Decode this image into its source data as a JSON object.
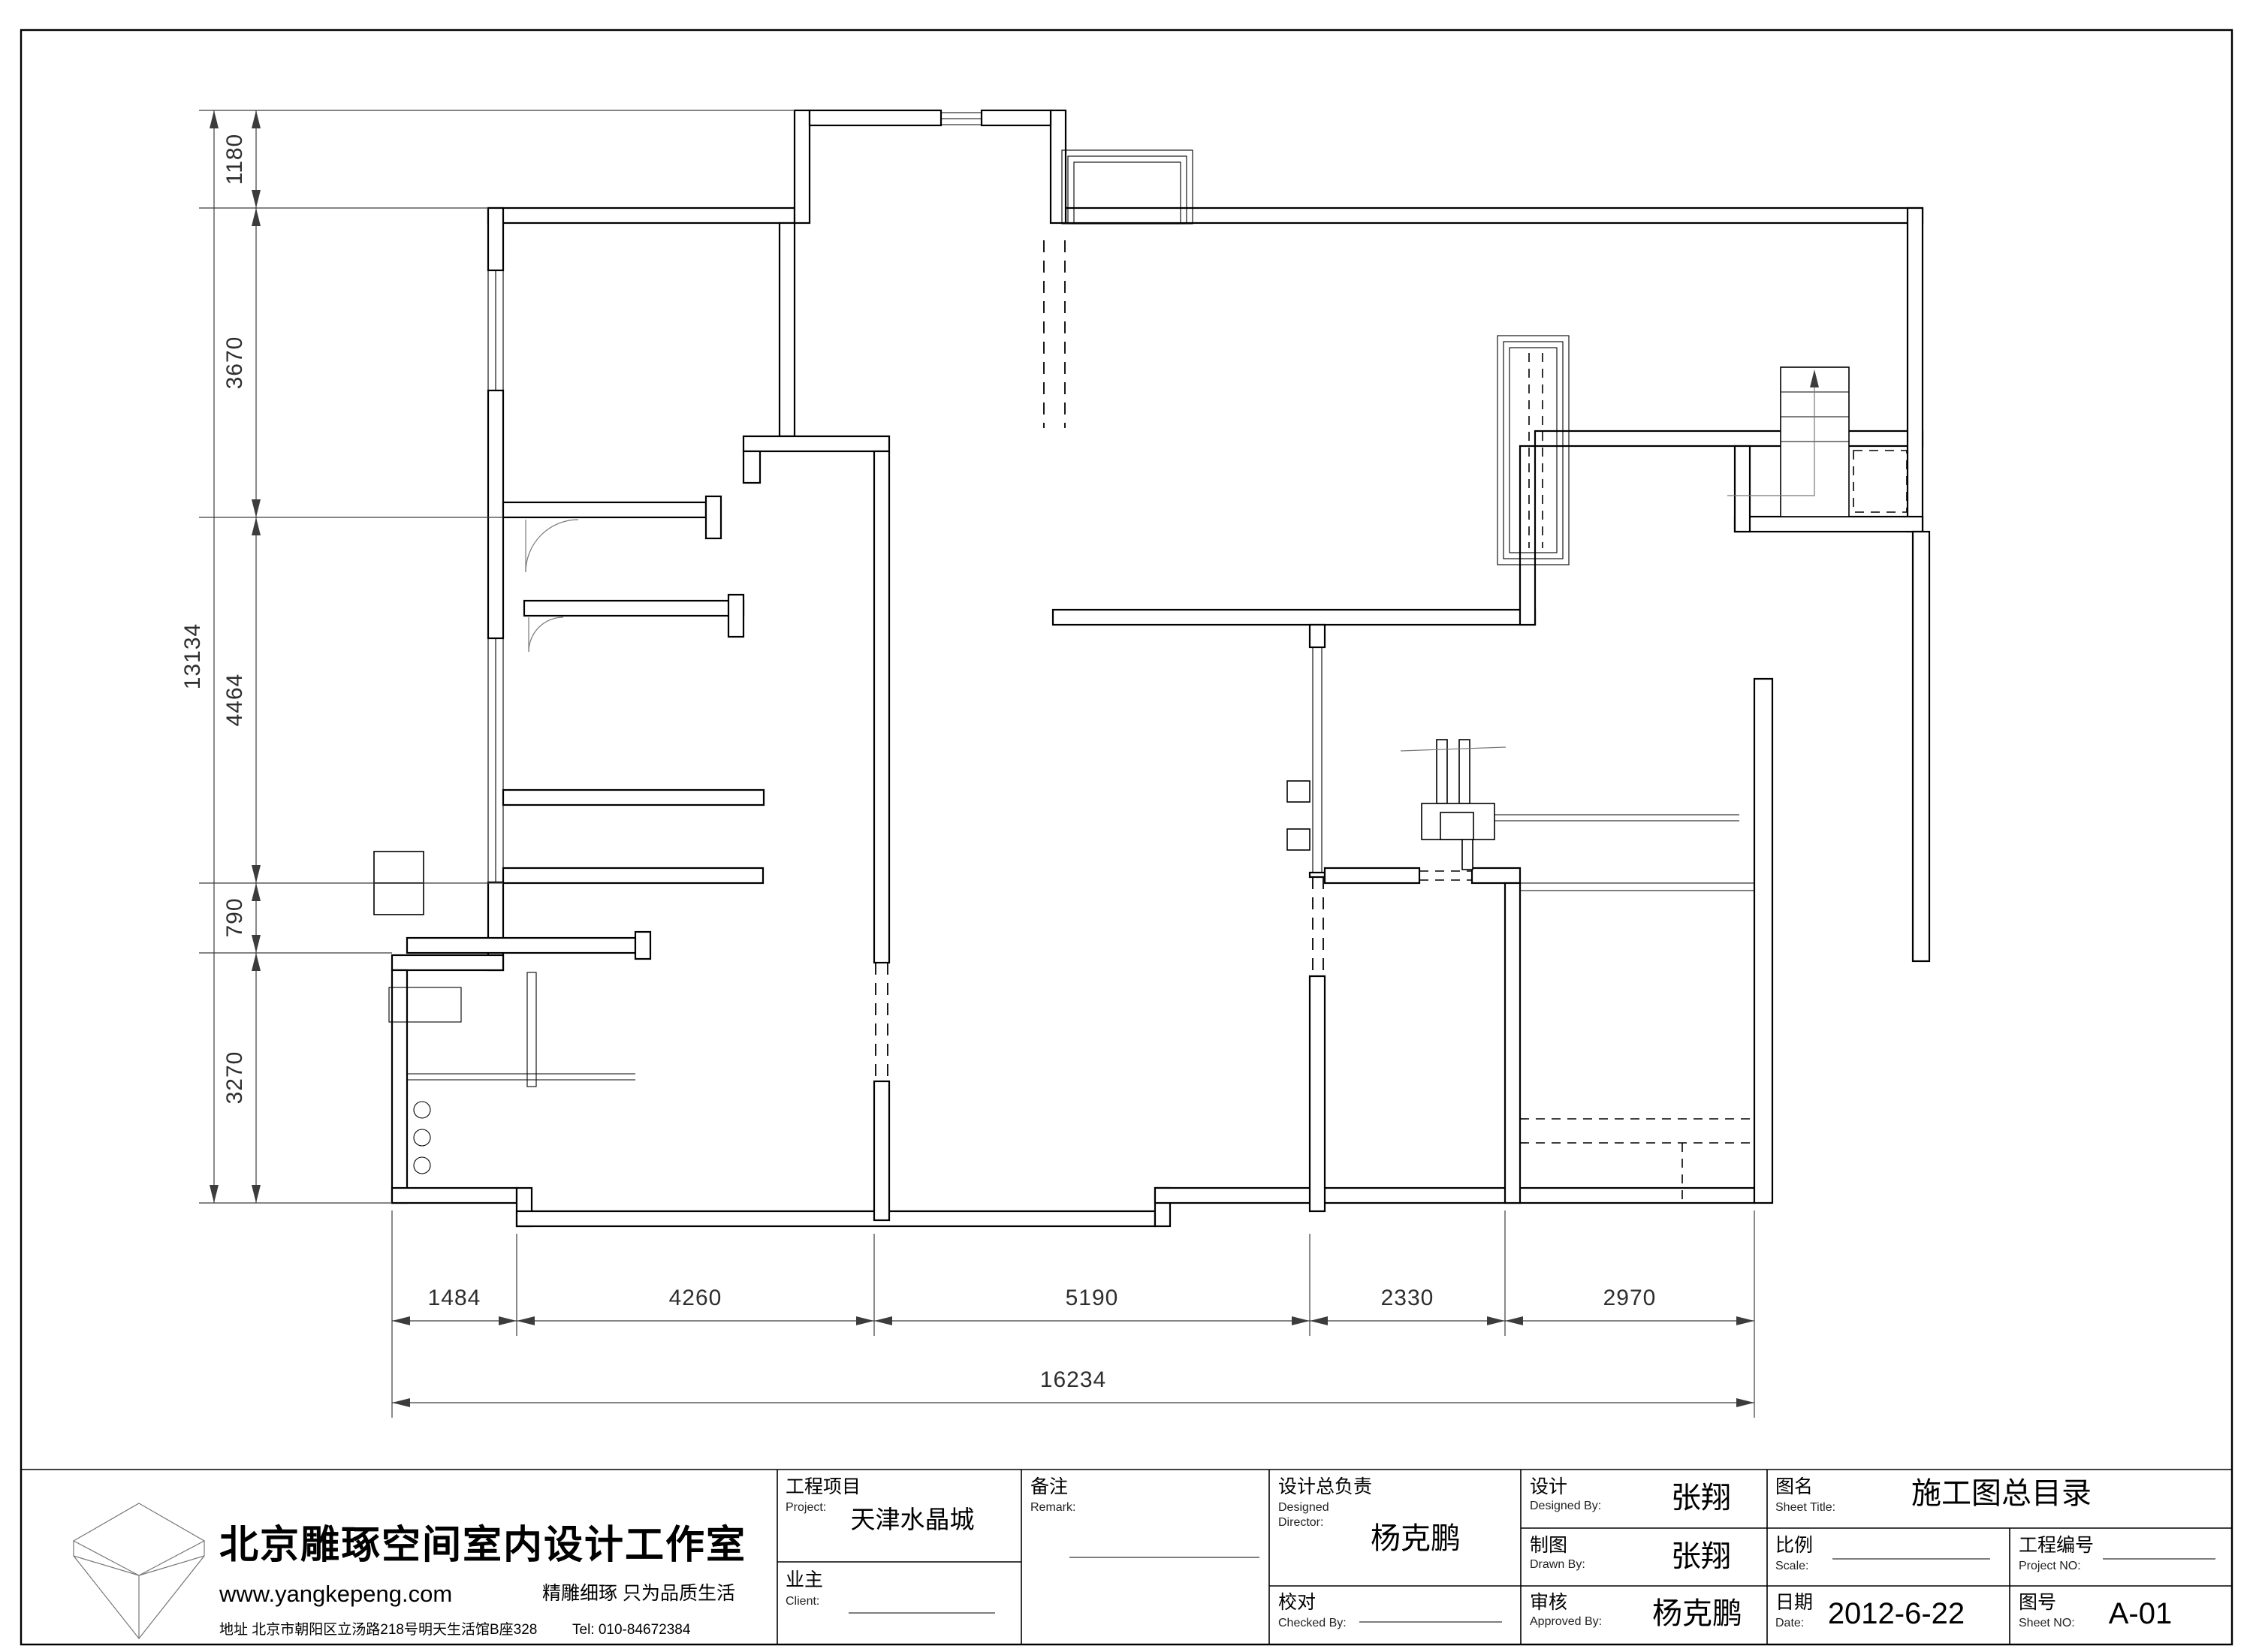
{
  "dims": {
    "left": [
      "1180",
      "3670",
      "4464",
      "790",
      "3270"
    ],
    "left_total": "13134",
    "bottom": [
      "1484",
      "4260",
      "5190",
      "2330",
      "2970"
    ],
    "bottom_total": "16234"
  },
  "company": {
    "name": "北京雕琢空间室内设计工作室",
    "website": "www.yangkepeng.com",
    "slogan": "精雕细琢 只为品质生活",
    "address": "地址 北京市朝阳区立汤路218号明天生活馆B座328",
    "tel": "Tel: 010-84672384"
  },
  "title_block": {
    "project_label": "工程项目",
    "project_en": "Project:",
    "project_value": "天津水晶城",
    "client_label": "业主",
    "client_en": "Client:",
    "remark_label": "备注",
    "remark_en": "Remark:",
    "dd_label": "设计总负责",
    "dd_en1": "Designed",
    "dd_en2": "Director:",
    "dd_value": "杨克鹏",
    "design_label": "设计",
    "design_en": "Designed By:",
    "design_value": "张翔",
    "draw_label": "制图",
    "draw_en": "Drawn By:",
    "draw_value": "张翔",
    "check_label": "校对",
    "check_en": "Checked By:",
    "approve_label": "审核",
    "approve_en": "Approved By:",
    "approve_value": "杨克鹏",
    "sheettitle_label": "图名",
    "sheettitle_en": "Sheet Title:",
    "sheettitle_value": "施工图总目录",
    "scale_label": "比例",
    "scale_en": "Scale:",
    "projno_label": "工程编号",
    "projno_en": "Project NO:",
    "date_label": "日期",
    "date_en": "Date:",
    "date_value": "2012-6-22",
    "sheetno_label": "图号",
    "sheetno_en": "Sheet NO:",
    "sheetno_value": "A-01"
  }
}
